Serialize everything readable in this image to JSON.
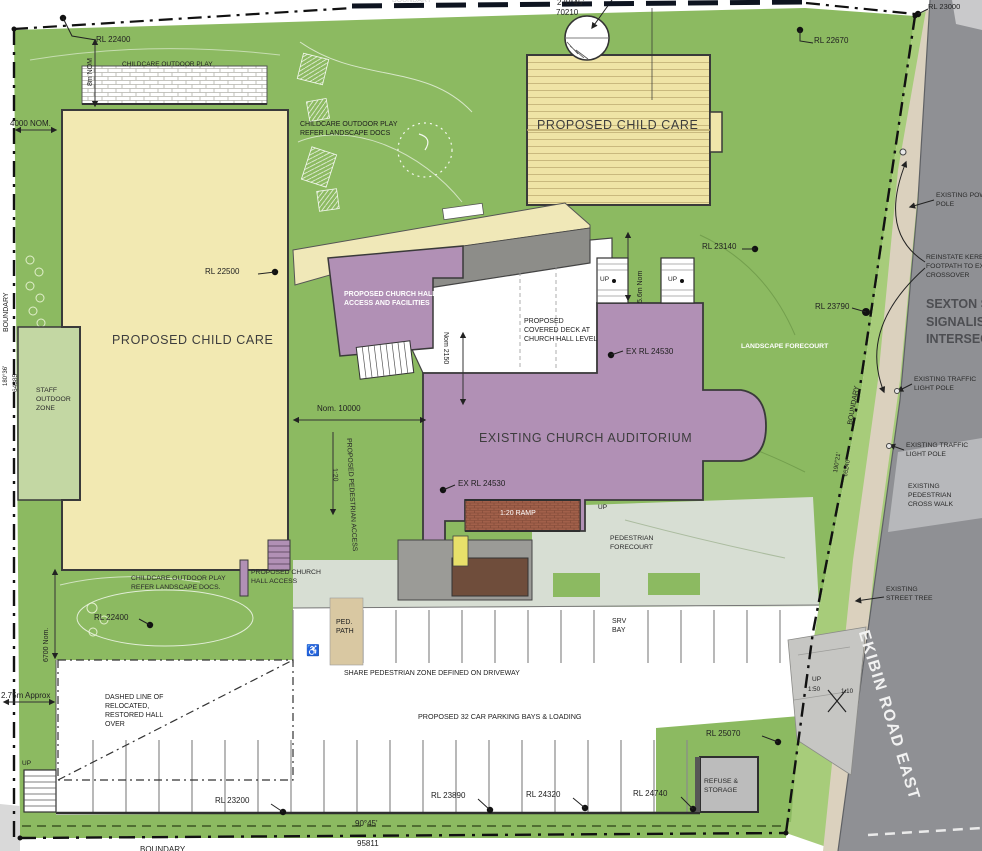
{
  "boundary": {
    "top_label": "BOUNDARY",
    "top_bearing": "270°45'",
    "top_distance": "70210",
    "bottom_label": "BOUNDARY",
    "bottom_bearing": "90°45'",
    "bottom_distance": "95811",
    "left_label": "BOUNDARY",
    "left_bearing": "180°36'",
    "left_distance": "64385",
    "right_label": "BOUNDARY",
    "right_bearing": "190°21'",
    "right_distance": "65240"
  },
  "buildings": {
    "childcare_left": "PROPOSED CHILD CARE",
    "childcare_top": "PROPOSED CHILD CARE",
    "auditorium": "EXISTING CHURCH AUDITORIUM",
    "hall_access_facilities": [
      "PROPOSED CHURCH HALL",
      "ACCESS AND FACILITIES"
    ],
    "covered_deck": [
      "PROPOSED",
      "COVERED DECK AT",
      "CHURCH HALL LEVEL"
    ],
    "hall_access": [
      "PROPOSED CHURCH",
      "HALL ACCESS"
    ],
    "refuse": [
      "REFUSE &",
      "STORAGE"
    ]
  },
  "zones": {
    "play_top": "CHILDCARE OUTDOOR PLAY",
    "play_mid": [
      "CHILDCARE OUTDOOR PLAY",
      "REFER LANDSCAPE DOCS"
    ],
    "play_low": [
      "CHILDCARE OUTDOOR PLAY",
      "REFER LANDSCAPE DOCS."
    ],
    "staff": [
      "STAFF",
      "OUTDOOR",
      "ZONE"
    ],
    "landscape_forecourt": "LANDSCAPE FORECOURT",
    "pedestrian_forecourt": [
      "PEDESTRIAN",
      "FORECOURT"
    ],
    "ped_path": [
      "PED.",
      "PATH"
    ],
    "srv_bay": [
      "SRV",
      "BAY"
    ],
    "ramp": "1:20 RAMP",
    "share_zone": "SHARE PEDESTRIAN ZONE DEFINED ON DRIVEWAY",
    "parking": "PROPOSED 32 CAR PARKING BAYS & LOADING",
    "dashed_hall": [
      "DASHED LINE OF",
      "RELOCATED,",
      "RESTORED HALL",
      "OVER"
    ],
    "ped_access": "PROPOSED PEDESTRIAN ACCESS",
    "ped_access_grade": "1:20"
  },
  "levels": {
    "rl_22400_top": "RL 22400",
    "rl_22670": "RL 22670",
    "rl_23000": "RL 23000",
    "rl_22500": "RL 22500",
    "rl_23140": "RL 23140",
    "rl_23790": "RL 23790",
    "ex_rl_24530_a": "EX RL 24530",
    "ex_rl_24530_b": "EX RL 24530",
    "rl_22400_low": "RL 22400",
    "rl_23200": "RL 23200",
    "rl_23890": "RL 23890",
    "rl_24320": "RL 24320",
    "rl_24740": "RL 24740",
    "rl_25070": "RL 25070"
  },
  "dims": {
    "d_8m": "8m NOM",
    "d_4000": "4000 NOM.",
    "d_6700": "6700 Nom.",
    "d_275": "2.75m Approx",
    "d_10000": "Nom. 10000",
    "d_2150": "Nom 2150",
    "d_56m": "5.6m Nom",
    "up": "UP",
    "up_150": "1:50",
    "up_110": "1:10"
  },
  "roads": {
    "ekibin": "EKIBIN ROAD EAST",
    "sexton": [
      "SEXTON ST",
      "SIGNALISE",
      "INTERSECT"
    ]
  },
  "notes": {
    "power_pole": [
      "EXISTING POWER",
      "POLE"
    ],
    "reinstate": [
      "REINSTATE KERB &",
      "FOOTPATH TO EXIST.",
      "CROSSOVER"
    ],
    "traffic_pole_1": [
      "EXISTING TRAFFIC",
      "LIGHT POLE"
    ],
    "traffic_pole_2": [
      "EXISTING TRAFFIC",
      "LIGHT POLE"
    ],
    "crosswalk": [
      "EXISTING",
      "PEDESTRIAN",
      "CROSS WALK"
    ],
    "street_tree": [
      "EXISTING",
      "STREET TREE"
    ]
  },
  "icons": {
    "wheelchair": "♿"
  },
  "colors": {
    "grass": "#8cba61",
    "grass_light": "#a7cc7a",
    "staff_green": "#c3d7a3",
    "building_yellow": "#f2e9b2",
    "purple": "#b190b5",
    "road_gray": "#8f9094",
    "footpath_tan": "#dbd1be",
    "ramp_brown": "#a2604a",
    "forecourt": "#d7ded3",
    "deck_gray": "#8d8d89",
    "refuse_gray": "#bcbcbc",
    "ped_path_tan": "#d9c8a2"
  }
}
